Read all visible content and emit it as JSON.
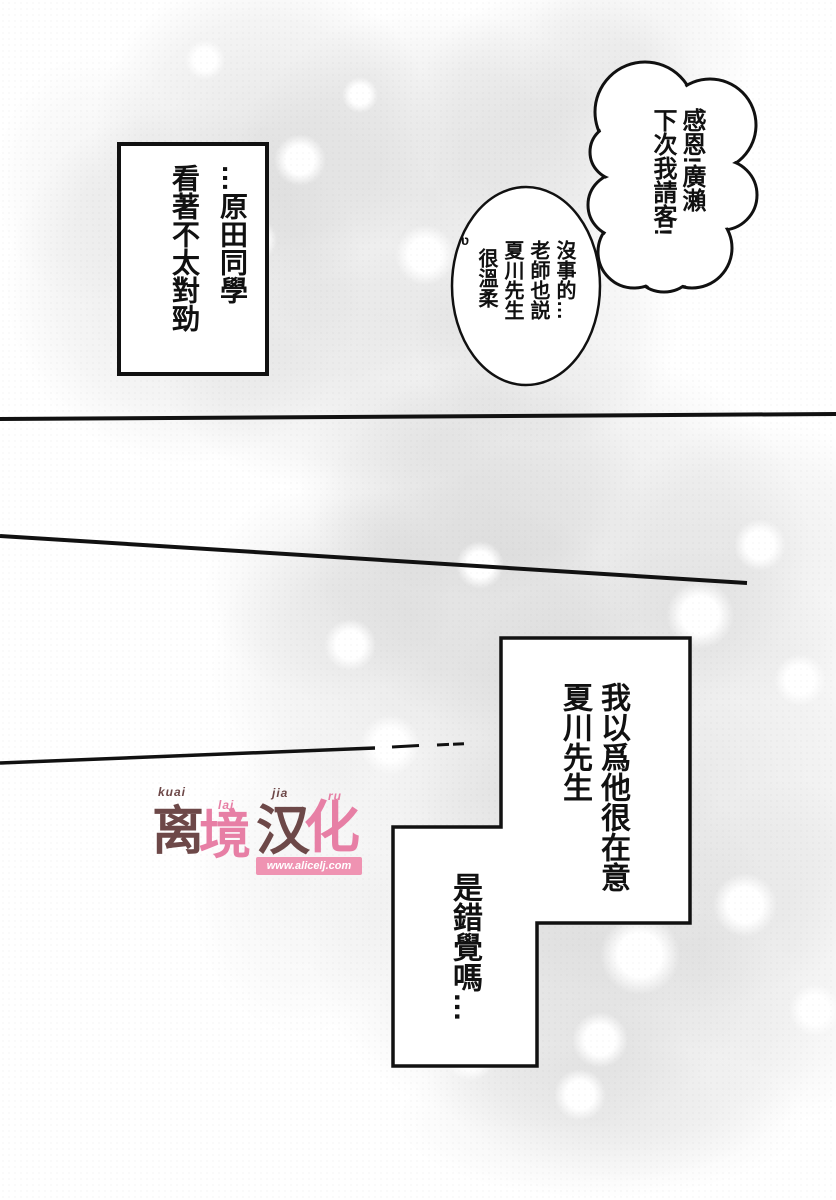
{
  "bubbles": {
    "cloud": {
      "columns": [
        "感恩!廣瀨",
        "下次我請客!"
      ]
    },
    "oval": {
      "mark": "ʋ",
      "columns": [
        "沒事的…",
        "老師也説",
        "夏川先生",
        "很溫柔"
      ]
    }
  },
  "captions": {
    "box_top_left": {
      "columns": [
        "…原田同學",
        "看著不太對勁"
      ]
    },
    "box_right": {
      "upper_columns": [
        "我以爲他很在意",
        "夏川先生"
      ],
      "lower_column": "是錯覺嗎…"
    }
  },
  "watermark": {
    "ruby": [
      "kuai",
      "lai",
      "jia",
      "ru"
    ],
    "chars": [
      "离",
      "境",
      "汉",
      "化"
    ],
    "url": "www.alicelj.com",
    "colors": {
      "dark_brown": "#6d4848",
      "pink": "#e77fa5",
      "url_bg": "#ef93b2",
      "url_text": "#ffffff"
    }
  },
  "colors": {
    "ink": "#111111",
    "paper": "#ffffff",
    "tone_gray": "#969696"
  }
}
